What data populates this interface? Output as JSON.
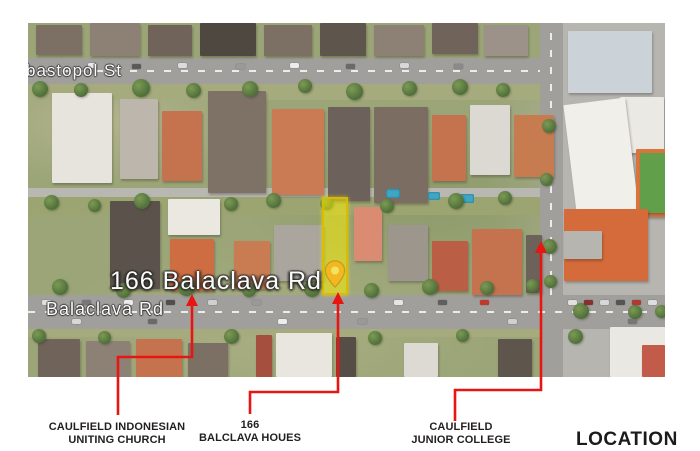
{
  "caption": "LOCATION",
  "map": {
    "street_labels": {
      "sevastopol": "bastopol St",
      "address_overlay": "166 Balaclava Rd",
      "balaclava": "Balaclava Rd"
    },
    "highlight_parcel": {
      "name": "166-balaclava-rd-site",
      "fill": "#fff000",
      "border": "#d7bc00"
    },
    "pin_fill": "#f2b824",
    "pin_stroke": "#c99a15",
    "pin_hole": "#f3e162",
    "colors": {
      "road": "#a19f9b",
      "lane": "#b9b7b1",
      "school_paving": "#b7b5b0",
      "tree": "#4e6e39",
      "pool": "#3fa7c4",
      "college_roof": "#d56a3b",
      "court_green": "#619f4b",
      "court_border": "#d8743e"
    },
    "features": {
      "grounds": [
        [
          0,
          61,
          512,
          16,
          "#a6ab7e"
        ],
        [
          0,
          174,
          512,
          18,
          "#9ca572"
        ],
        [
          0,
          306,
          637,
          8,
          "#a6ab7e"
        ]
      ],
      "roads": [
        [
          535,
          0,
          102,
          354,
          "#b7b5b0"
        ],
        [
          512,
          0,
          23,
          354,
          "#a19f9b"
        ],
        [
          0,
          35,
          535,
          26,
          "#a19f9b"
        ],
        [
          0,
          165,
          512,
          9,
          "#b9b7b1"
        ],
        [
          0,
          272,
          637,
          34,
          "#a19f9b"
        ]
      ],
      "markings": [
        [
          0,
          47,
          512,
          2,
          "h"
        ],
        [
          0,
          288,
          637,
          2,
          "h"
        ],
        [
          522,
          0,
          2,
          272,
          "v"
        ]
      ],
      "buildings": [
        [
          8,
          2,
          46,
          30,
          "#7c7065"
        ],
        [
          62,
          0,
          50,
          33,
          "#8d8176"
        ],
        [
          120,
          2,
          44,
          31,
          "#6f635a"
        ],
        [
          172,
          0,
          56,
          33,
          "#4f4841"
        ],
        [
          236,
          2,
          48,
          31,
          "#7c7065"
        ],
        [
          292,
          0,
          46,
          33,
          "#5e554d"
        ],
        [
          346,
          2,
          50,
          31,
          "#8d8176"
        ],
        [
          404,
          0,
          46,
          31,
          "#6f635a"
        ],
        [
          456,
          2,
          44,
          31,
          "#9c9289"
        ],
        [
          24,
          70,
          60,
          90,
          "#e6e4dd"
        ],
        [
          92,
          76,
          38,
          80,
          "#bcb6ac"
        ],
        [
          134,
          88,
          40,
          70,
          "#c5734e"
        ],
        [
          180,
          68,
          58,
          102,
          "#7e7266"
        ],
        [
          244,
          86,
          52,
          86,
          "#cb7b53"
        ],
        [
          300,
          84,
          42,
          94,
          "#6c625b"
        ],
        [
          346,
          84,
          54,
          96,
          "#7b6d61"
        ],
        [
          404,
          92,
          34,
          66,
          "#c5734e"
        ],
        [
          442,
          82,
          40,
          70,
          "#dcd9d2"
        ],
        [
          486,
          92,
          40,
          62,
          "#c77c50"
        ],
        [
          82,
          178,
          50,
          88,
          "#5b534b"
        ],
        [
          140,
          176,
          52,
          36,
          "#eae8e1"
        ],
        [
          142,
          216,
          44,
          52,
          "#ce6c42"
        ],
        [
          206,
          218,
          36,
          48,
          "#c97c52"
        ],
        [
          246,
          202,
          50,
          56,
          "#aaa59d"
        ],
        [
          326,
          184,
          28,
          54,
          "#da8c72"
        ],
        [
          360,
          202,
          40,
          56,
          "#9d968d"
        ],
        [
          404,
          218,
          36,
          50,
          "#ba5e46"
        ],
        [
          444,
          206,
          50,
          66,
          "#c5734e"
        ],
        [
          498,
          212,
          16,
          58,
          "#6c6259"
        ],
        [
          10,
          316,
          42,
          38,
          "#6f635a"
        ],
        [
          58,
          318,
          44,
          36,
          "#8d8176"
        ],
        [
          108,
          316,
          46,
          38,
          "#c5734e"
        ],
        [
          160,
          320,
          40,
          34,
          "#7c7065"
        ],
        [
          228,
          312,
          16,
          42,
          "#a5503f"
        ],
        [
          248,
          310,
          56,
          44,
          "#e8e6df"
        ],
        [
          308,
          314,
          20,
          40,
          "#554d46"
        ],
        [
          376,
          320,
          34,
          34,
          "#dddad3"
        ],
        [
          470,
          316,
          34,
          38,
          "#5e554d"
        ],
        [
          582,
          304,
          56,
          50,
          "#eae8e2"
        ],
        [
          614,
          322,
          23,
          32,
          "#c25b49"
        ],
        [
          540,
          8,
          84,
          62,
          "#ccd3d8"
        ],
        [
          592,
          74,
          44,
          56,
          "#ebe9e3"
        ],
        [
          542,
          78,
          62,
          112,
          "#f1efe9",
          -7
        ],
        [
          608,
          126,
          33,
          68,
          "#d8743e"
        ],
        [
          612,
          130,
          25,
          60,
          "#619f4b"
        ],
        [
          536,
          186,
          84,
          72,
          "#d56a3b"
        ],
        [
          536,
          208,
          38,
          28,
          "#b7b5b0"
        ]
      ],
      "pools": [
        [
          358,
          166,
          14,
          9
        ],
        [
          400,
          169,
          12,
          8
        ],
        [
          432,
          171,
          14,
          9
        ]
      ],
      "trees": [
        [
          4,
          58,
          16
        ],
        [
          46,
          60,
          14
        ],
        [
          104,
          56,
          18
        ],
        [
          158,
          60,
          15
        ],
        [
          214,
          58,
          16
        ],
        [
          270,
          56,
          14
        ],
        [
          318,
          60,
          17
        ],
        [
          374,
          58,
          15
        ],
        [
          424,
          56,
          16
        ],
        [
          468,
          60,
          14
        ],
        [
          16,
          172,
          15
        ],
        [
          60,
          176,
          13
        ],
        [
          106,
          170,
          16
        ],
        [
          196,
          174,
          14
        ],
        [
          238,
          170,
          15
        ],
        [
          292,
          174,
          13
        ],
        [
          352,
          176,
          14
        ],
        [
          420,
          170,
          16
        ],
        [
          470,
          168,
          14
        ],
        [
          24,
          256,
          16
        ],
        [
          88,
          260,
          15
        ],
        [
          150,
          256,
          17
        ],
        [
          214,
          260,
          14
        ],
        [
          276,
          258,
          16
        ],
        [
          336,
          260,
          15
        ],
        [
          394,
          256,
          16
        ],
        [
          452,
          258,
          14
        ],
        [
          498,
          256,
          13
        ],
        [
          4,
          306,
          14
        ],
        [
          70,
          308,
          13
        ],
        [
          196,
          306,
          15
        ],
        [
          340,
          308,
          14
        ],
        [
          428,
          306,
          13
        ],
        [
          540,
          306,
          15
        ],
        [
          514,
          96,
          14
        ],
        [
          512,
          150,
          13
        ],
        [
          514,
          216,
          15
        ],
        [
          516,
          252,
          13
        ],
        [
          600,
          282,
          14
        ],
        [
          627,
          282,
          13
        ],
        [
          545,
          280,
          16
        ]
      ],
      "cars": [
        [
          60,
          40,
          "#e9e9e9"
        ],
        [
          104,
          41,
          "#5a5a5a"
        ],
        [
          150,
          40,
          "#dcdcdc"
        ],
        [
          208,
          41,
          "#9a9a9a"
        ],
        [
          262,
          40,
          "#ececec"
        ],
        [
          318,
          41,
          "#6a6a6a"
        ],
        [
          372,
          40,
          "#d8d8d8"
        ],
        [
          426,
          41,
          "#8a8a8a"
        ],
        [
          14,
          277,
          "#e0e0e0"
        ],
        [
          54,
          277,
          "#777777"
        ],
        [
          96,
          277,
          "#ececec"
        ],
        [
          138,
          277,
          "#4f4f4f"
        ],
        [
          180,
          277,
          "#d0d0d0"
        ],
        [
          224,
          277,
          "#999999"
        ],
        [
          366,
          277,
          "#e6e6e6"
        ],
        [
          410,
          277,
          "#5f5f5f"
        ],
        [
          452,
          277,
          "#c0392b"
        ],
        [
          540,
          277,
          "#e0e0e0"
        ],
        [
          556,
          277,
          "#8a2f2f"
        ],
        [
          572,
          277,
          "#d8d8d8"
        ],
        [
          588,
          277,
          "#555555"
        ],
        [
          604,
          277,
          "#b03a30"
        ],
        [
          620,
          277,
          "#dddddd"
        ],
        [
          44,
          296,
          "#d8d8d8"
        ],
        [
          120,
          296,
          "#6a6a6a"
        ],
        [
          250,
          296,
          "#ececec"
        ],
        [
          330,
          296,
          "#999999"
        ],
        [
          480,
          296,
          "#d0d0d0"
        ],
        [
          600,
          296,
          "#777777"
        ]
      ]
    }
  },
  "annotations": {
    "line_color": "#e81612",
    "items": [
      {
        "id": "church",
        "lines": [
          "CAULFIELD INDONESIAN",
          "UNITING CHURCH"
        ],
        "path": "M118 415 L118 357 L192 357 L192 302",
        "arrow": "192,294 186,306 198,306"
      },
      {
        "id": "site-166",
        "lines": [
          "166",
          "BALCLAVA HOUES"
        ],
        "path": "M250 414 L250 392 L338 392 L338 300",
        "arrow": "338,292 332,304 344,304"
      },
      {
        "id": "college",
        "lines": [
          "CAULFIELD",
          "JUNIOR COLLEGE"
        ],
        "path": "M455 421 L455 390 L541 390 L541 249",
        "arrow": "541,241 535,253 547,253"
      }
    ]
  }
}
